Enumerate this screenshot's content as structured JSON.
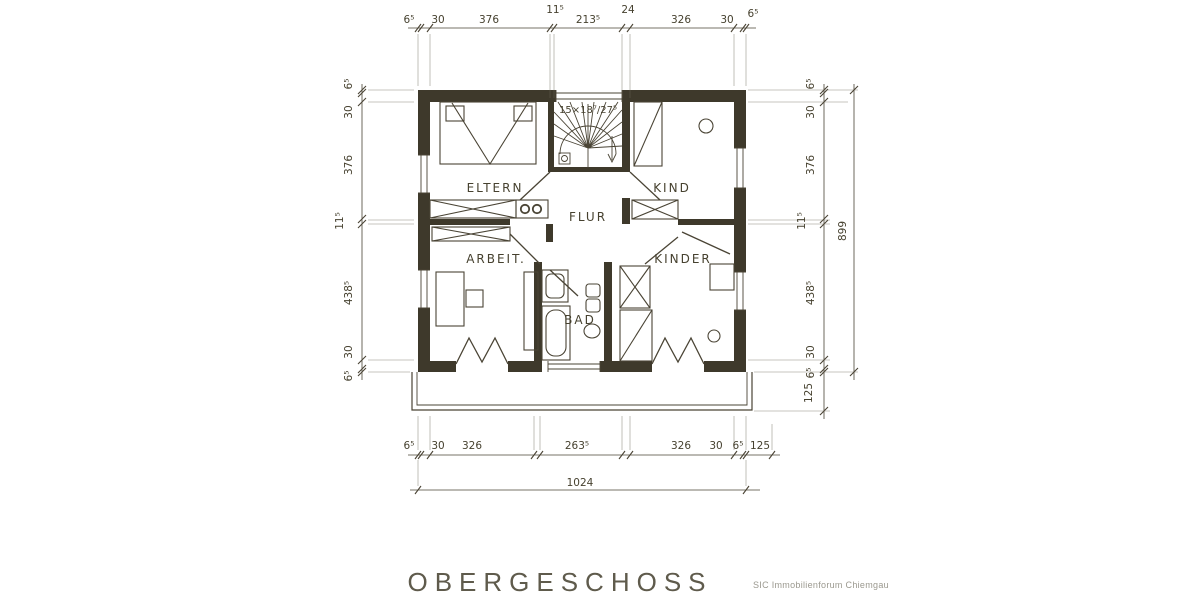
{
  "title": "OBERGESCHOSS",
  "watermark": "SIC Immobilienforum Chiemgau",
  "rooms": {
    "eltern": "ELTERN",
    "kind": "KIND",
    "flur": "FLUR",
    "arbeit": "ARBEIT.",
    "kinder": "KINDER",
    "bad": "BAD"
  },
  "stair_label": "15×18⁷/27⁵",
  "dims": {
    "top": [
      "6⁵",
      "30",
      "376",
      "11⁵",
      "213⁵",
      "24",
      "326",
      "30",
      "6⁵"
    ],
    "bottom": [
      "6⁵",
      "30",
      "326",
      "263⁵",
      "326",
      "30",
      "6⁵",
      "125"
    ],
    "bottom_total": "1024",
    "left": [
      "6⁵",
      "30",
      "376",
      "11⁵",
      "438⁵",
      "30",
      "6⁵"
    ],
    "right": [
      "6⁵",
      "30",
      "376",
      "11⁵",
      "438⁵",
      "30",
      "6⁵",
      "125"
    ],
    "right_total": "899"
  },
  "colors": {
    "ink": "#4a4435",
    "wall_fill": "#3e392b",
    "paper": "#ffffff",
    "watermark_gray": "#9b998f"
  }
}
